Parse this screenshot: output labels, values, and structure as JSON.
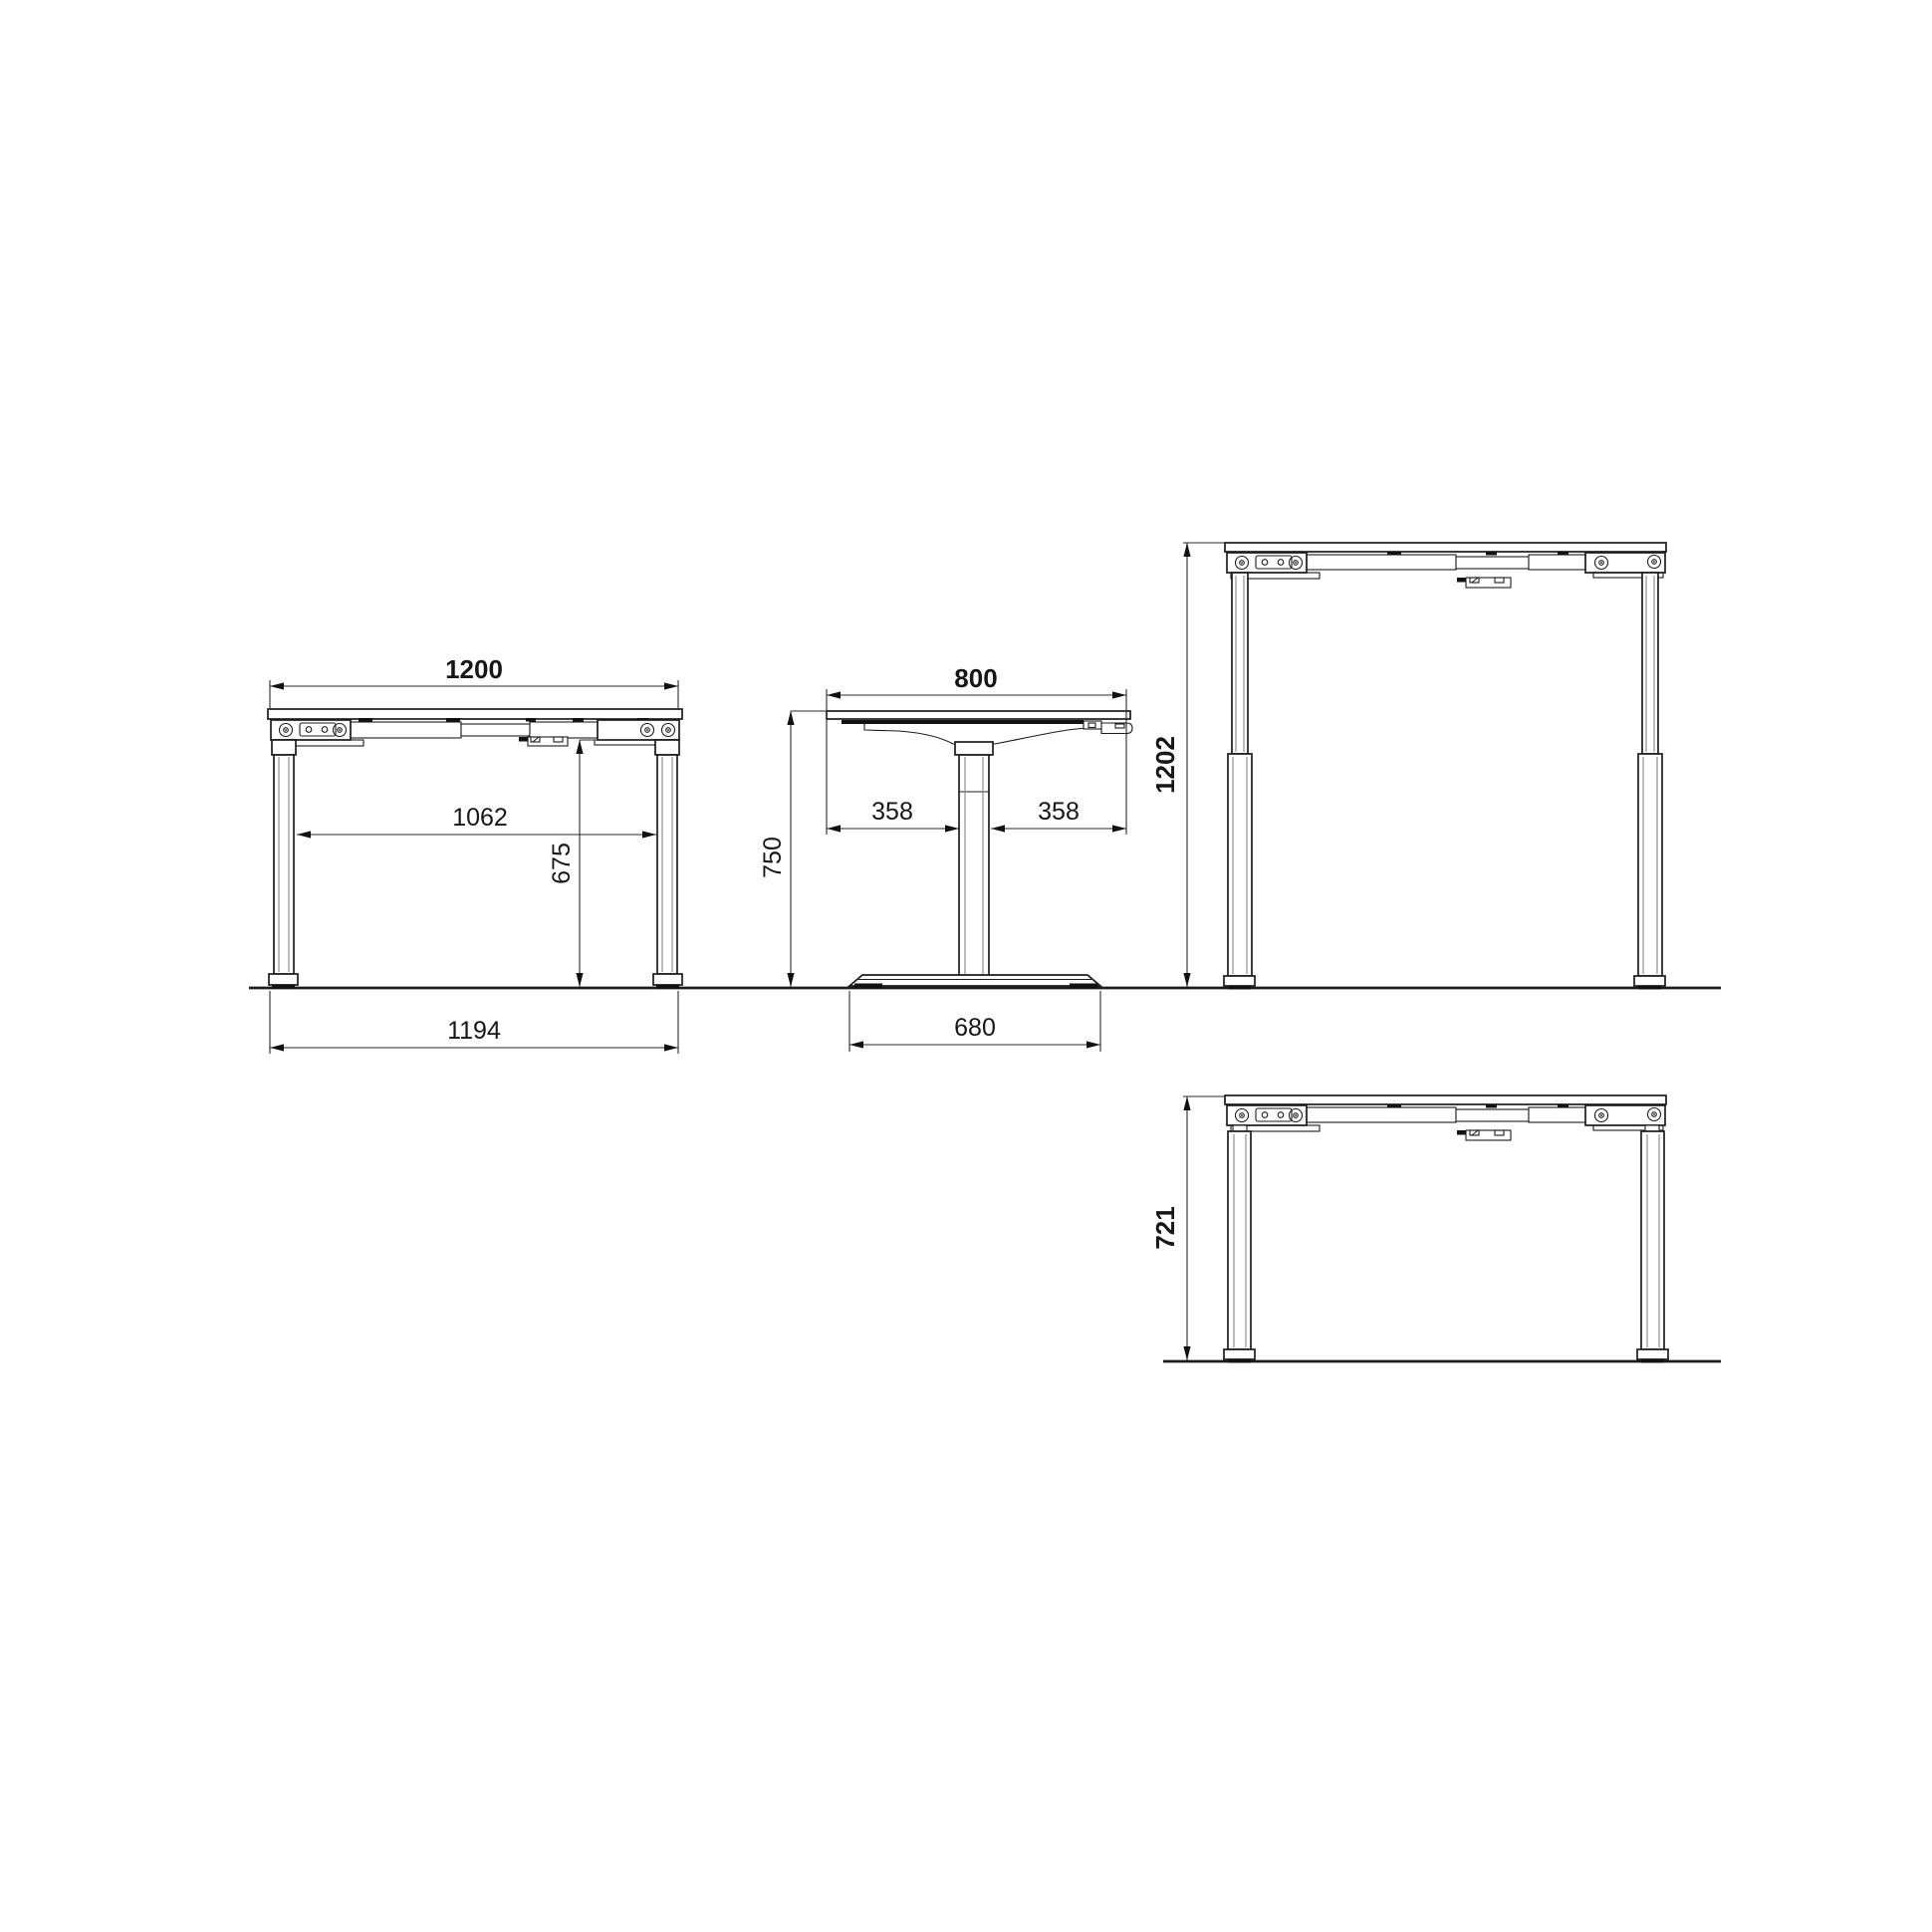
{
  "page": {
    "background": "#ffffff"
  },
  "drawing": {
    "type": "technical-dimension-drawing",
    "subject": "height-adjustable-desk-frame",
    "line_color": "#1c1c1c",
    "views": {
      "front": {
        "dims": {
          "top_width": "1200",
          "clear_inner_width": "1062",
          "underframe_clearance": "675",
          "foot_outer_span": "1194"
        }
      },
      "side": {
        "dims": {
          "top_depth": "800",
          "left_overhang": "358",
          "right_overhang": "358",
          "top_height": "750",
          "foot_length": "680"
        }
      },
      "front_raised": {
        "dims": {
          "max_height": "1202"
        }
      },
      "front_lowered": {
        "dims": {
          "min_height": "721"
        }
      }
    }
  }
}
